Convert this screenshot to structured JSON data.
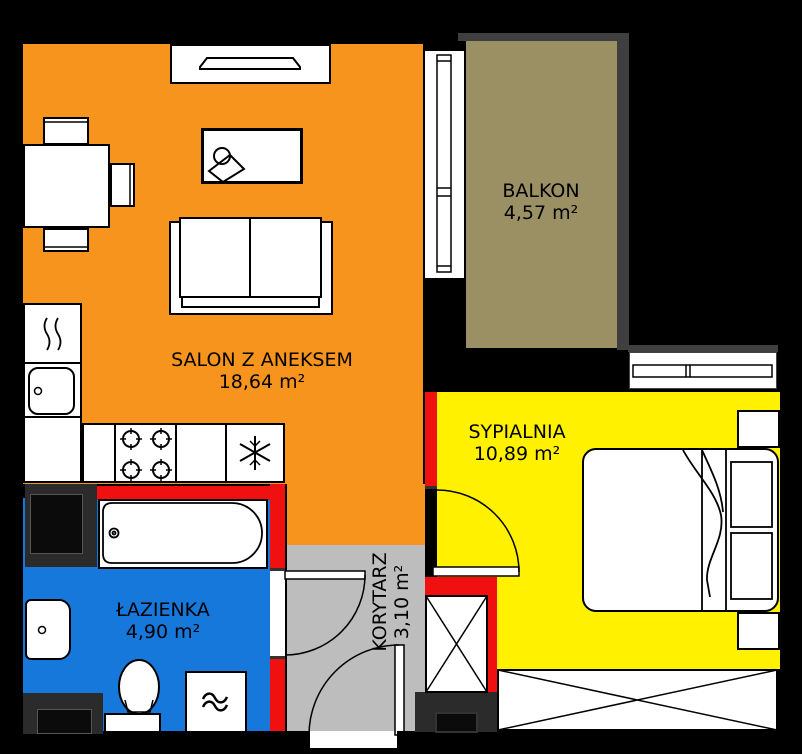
{
  "floorplan": {
    "rooms": [
      {
        "name": "SALON Z ANEKSEM",
        "area": "18,64 m²",
        "floor_color": "#F7941E"
      },
      {
        "name": "BALKON",
        "area": "4,57 m²",
        "floor_color": "#9A9064"
      },
      {
        "name": "SYPIALNIA",
        "area": "10,89 m²",
        "floor_color": "#FFF100"
      },
      {
        "name": "ŁAZIENKA",
        "area": "4,90 m²",
        "floor_color": "#1778DB"
      },
      {
        "name": "KORYTARZ",
        "area": "3,10 m²",
        "floor_color": "#BDBDBD"
      }
    ],
    "palette": {
      "background": "#000000",
      "wall_red": "#F01010",
      "shaft_dark": "#2B2B2B",
      "shaft_inner": "#0B0B0B",
      "window_bar_dark": "#3F3F3F",
      "furniture_fill": "#FFFFFF",
      "line_black": "#000000"
    },
    "furniture_icons": [
      "tv-console",
      "desk",
      "dining-table",
      "chair",
      "sofa",
      "kitchen-tall-cabinet",
      "kitchen-sink",
      "cooktop-burners",
      "fridge-freezer-snowflake",
      "bathtub",
      "washbasin",
      "toilet",
      "washing-machine",
      "double-bed",
      "nightstand",
      "wardrobe-x",
      "closet-x",
      "door-swing-arc",
      "window-frame",
      "balcony-door"
    ]
  }
}
